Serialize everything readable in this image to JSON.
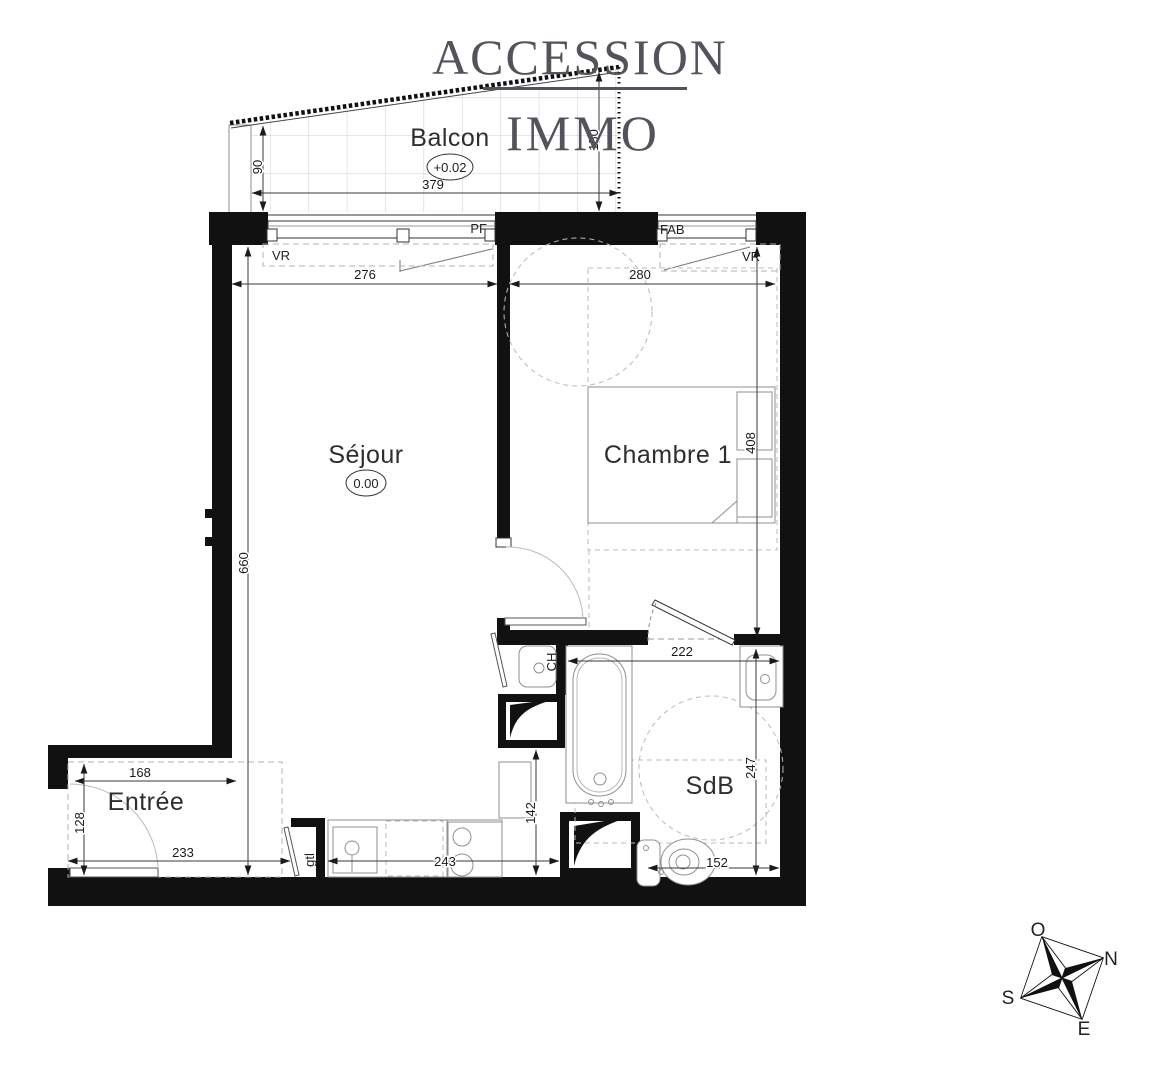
{
  "branding": {
    "line1": "ACCESSION",
    "line2": "IMMO"
  },
  "rooms": {
    "balcon": {
      "label": "Balcon",
      "elevation": "+0.02"
    },
    "sejour": {
      "label": "Séjour",
      "elevation": "0.00"
    },
    "chambre": {
      "label": "Chambre 1"
    },
    "entree": {
      "label": "Entrée"
    },
    "sdb": {
      "label": "SdB"
    }
  },
  "openings": {
    "pf": "PF",
    "fab": "FAB",
    "vr_left": "VR",
    "vr_right": "VR"
  },
  "technical": {
    "gtl": "gtl",
    "ch": "CH"
  },
  "dimensions_cm": {
    "balcon_width": "379",
    "balcon_depth_left": "90",
    "balcon_depth_right": "150",
    "sejour_width": "276",
    "sejour_length": "660",
    "chambre_width": "280",
    "chambre_length": "408",
    "sdb_width": "222",
    "sdb_length": "247",
    "sdb_wc": "152",
    "cuisine_run": "243",
    "cuisine_clearance": "142",
    "entree_width": "168",
    "entree_depth": "128",
    "entree_length": "233"
  },
  "compass": {
    "west": "O",
    "north": "N",
    "south": "S",
    "east": "E"
  },
  "colors": {
    "wall": "#111111",
    "logo": "#53535b",
    "dashed": "#b0b0b0",
    "grid": "#cccccc",
    "text": "#1a1a1a"
  }
}
